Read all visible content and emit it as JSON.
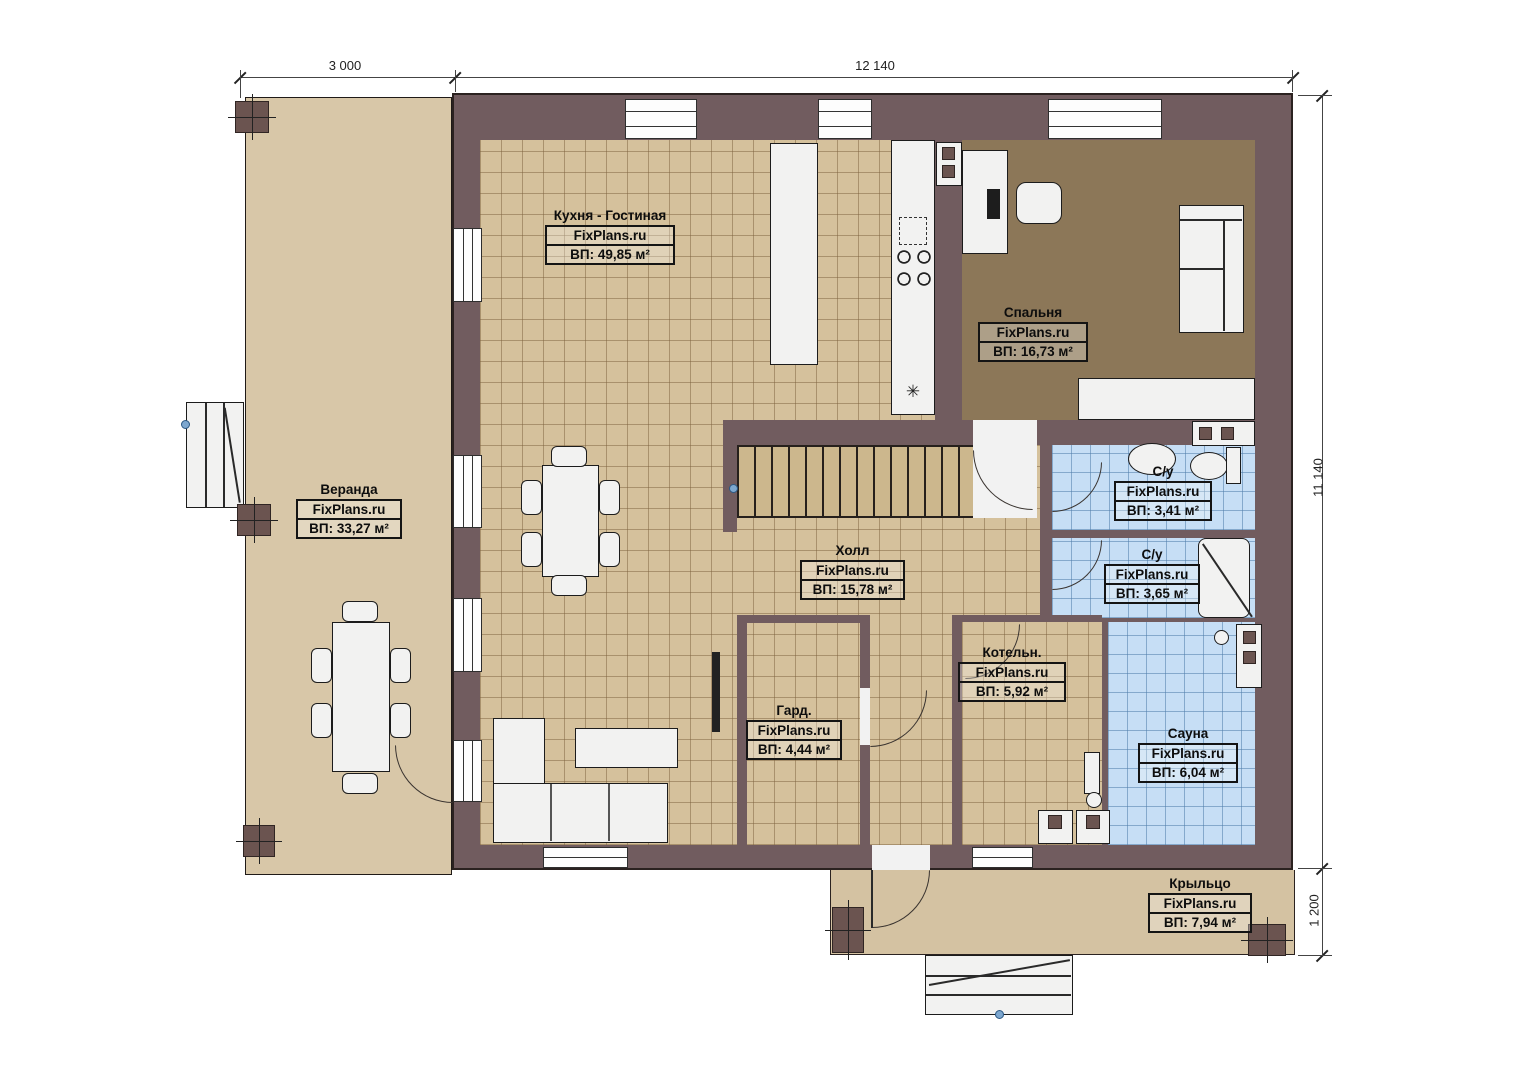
{
  "plan": {
    "rooms": {
      "kitchen_living": {
        "name": "Кухня - Гостиная",
        "watermark": "FixPlans.ru",
        "area": "ВП: 49,85 м²"
      },
      "bedroom": {
        "name": "Спальня",
        "watermark": "FixPlans.ru",
        "area": "ВП: 16,73 м²"
      },
      "veranda": {
        "name": "Веранда",
        "watermark": "FixPlans.ru",
        "area": "ВП: 33,27 м²"
      },
      "hall": {
        "name": "Холл",
        "watermark": "FixPlans.ru",
        "area": "ВП: 15,78 м²"
      },
      "bathroom_top": {
        "name": "С/у",
        "watermark": "FixPlans.ru",
        "area": "ВП: 3,41 м²"
      },
      "bathroom_mid": {
        "name": "С/у",
        "watermark": "FixPlans.ru",
        "area": "ВП: 3,65 м²"
      },
      "boiler": {
        "name": "Котельн.",
        "watermark": "FixPlans.ru",
        "area": "ВП: 5,92 м²"
      },
      "wardrobe": {
        "name": "Гард.",
        "watermark": "FixPlans.ru",
        "area": "ВП: 4,44 м²"
      },
      "sauna": {
        "name": "Сауна",
        "watermark": "FixPlans.ru",
        "area": "ВП: 6,04 м²"
      },
      "porch": {
        "name": "Крыльцо",
        "watermark": "FixPlans.ru",
        "area": "ВП: 7,94 м²"
      }
    },
    "dimensions": {
      "top_left": "3 000",
      "top_right": "12 140",
      "right": "11 140",
      "right_bottom": "1 200"
    },
    "symbols": {
      "fridge": "✳"
    },
    "colors": {
      "wall": "#715c5f",
      "tile_floor": "#d5c19c",
      "wood_floor": "#8c7758",
      "deck_floor": "#d8c7a8",
      "wet_floor": "#c6def5"
    }
  }
}
